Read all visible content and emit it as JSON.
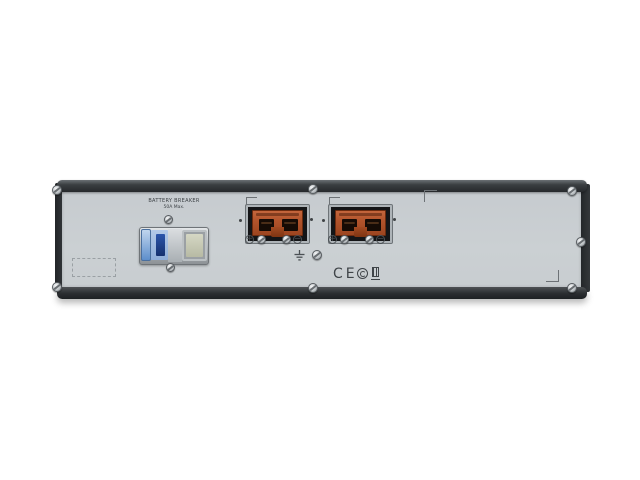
{
  "photo": {
    "description": "Rear panel of a 2U rack-mount UPS battery pack on white background",
    "colors": {
      "background": "#ffffff",
      "panel": "#c9ced2",
      "rails": "#2c2f32",
      "connector_orange": "#b2542c",
      "breaker_handle_blue": "#2c55ab"
    }
  },
  "breaker": {
    "label_line1": "BATTERY BREAKER",
    "label_line2": "50A Max."
  },
  "terminals": {
    "plus": "+",
    "minus": "−"
  },
  "certifications": {
    "ce": "CE",
    "marks": [
      "ce-mark",
      "round-conformity-mark",
      "square-conformity-mark"
    ]
  },
  "icons": {
    "screw": "phillips-screw-head",
    "ground": "earth-ground-symbol",
    "plus_terminal": "circled-plus",
    "minus_terminal": "circled-minus",
    "corner_bracket": "registration-corner-mark",
    "label_placeholder": "dashed-rectangle"
  }
}
